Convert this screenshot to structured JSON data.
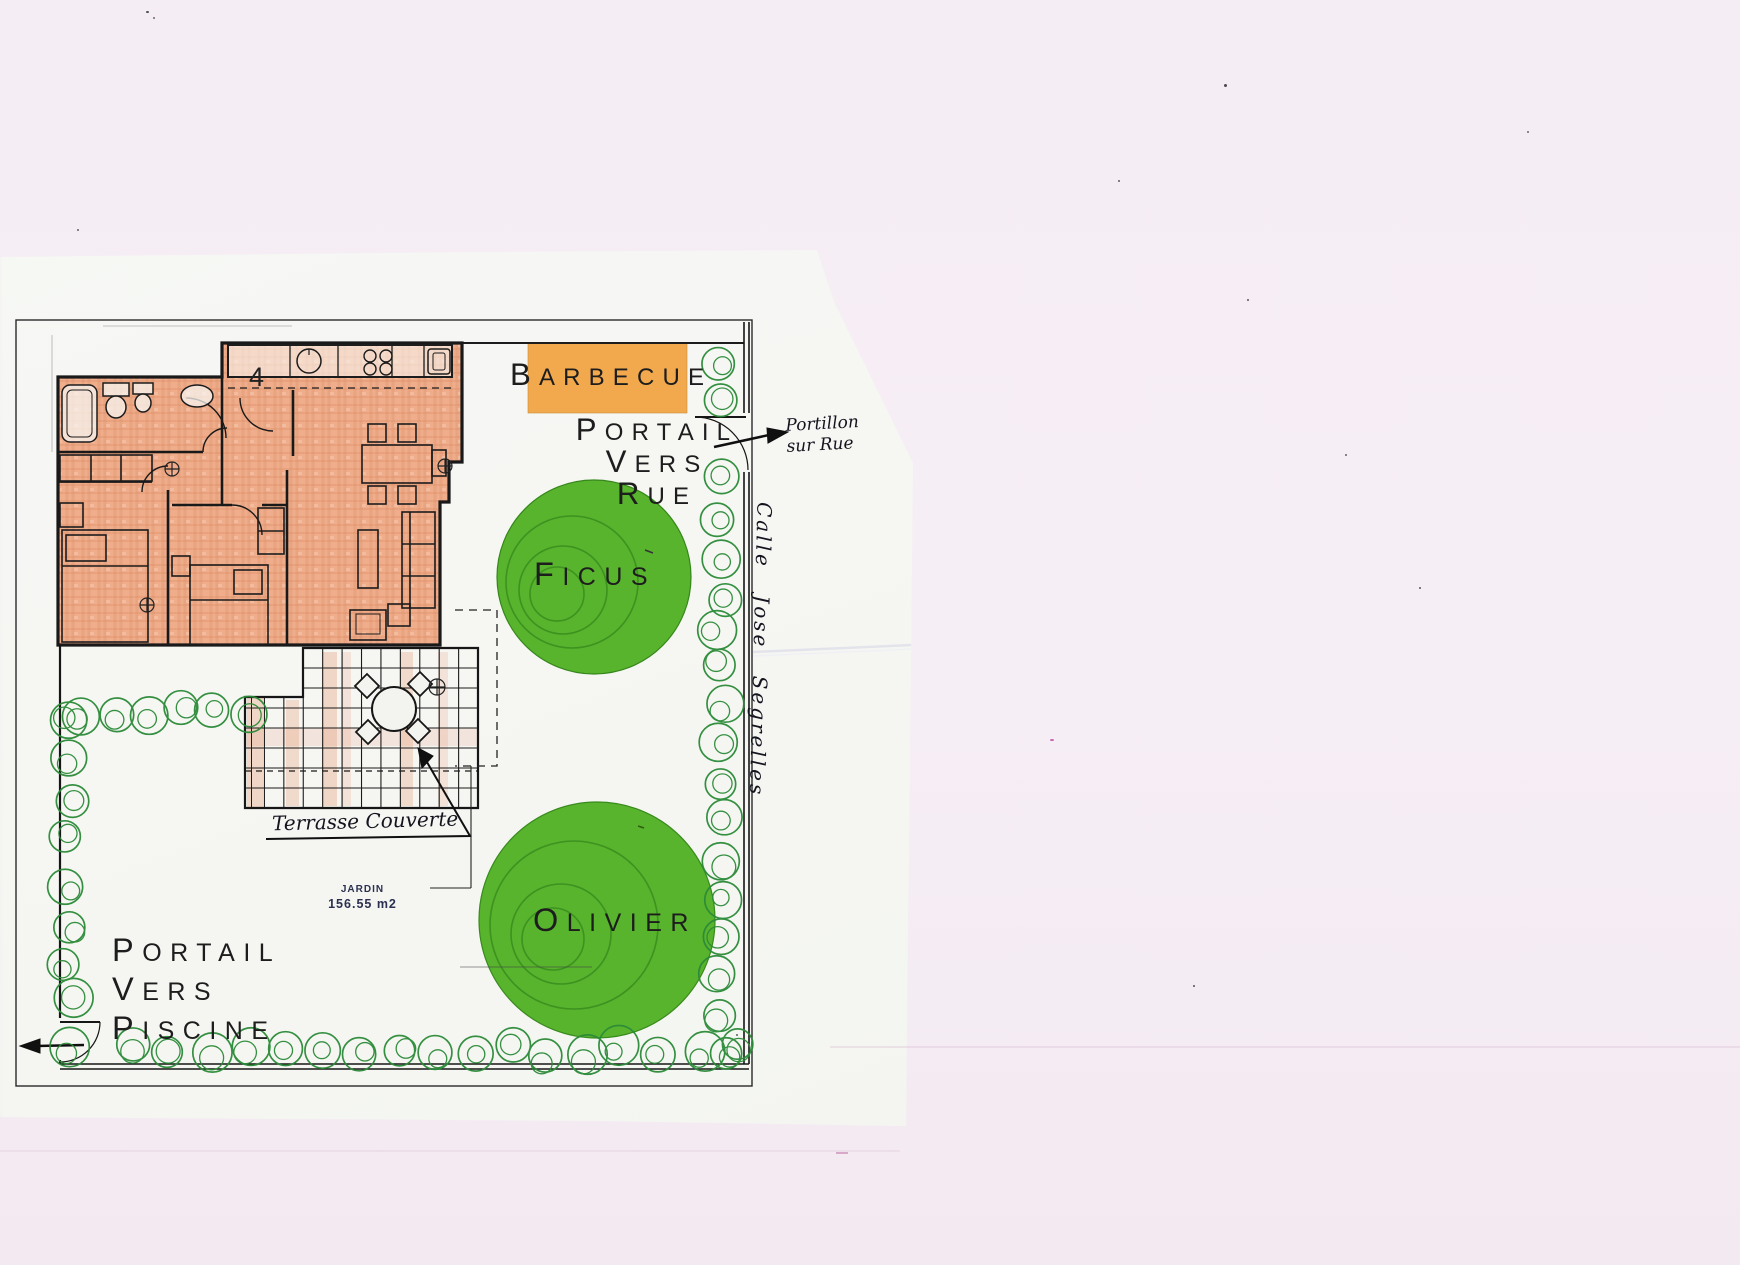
{
  "page": {
    "plan_labels": {
      "barbecue": "BARBECUE",
      "portail_rue": [
        "PORTAIL",
        "VERS",
        "RUE"
      ],
      "portail_piscine": [
        "PORTAIL",
        "VERS",
        "PISCINE"
      ],
      "ficus": "FICUS",
      "olivier": "OLIVIER",
      "jardin_name": "JARDIN",
      "jardin_area": "156.55 m2",
      "unit_number": "4"
    },
    "handwritten": {
      "portillon_line1": "Portillon",
      "portillon_line2": "sur Rue",
      "street_name": "Calle Jose Segrelles",
      "terrace": "Terrasse Couverte"
    }
  },
  "colors": {
    "background": "#f5edf4",
    "paper": "#f5f6f2",
    "crayon_fill": "#f0ad8c",
    "barbecue_fill": "#f2a94e",
    "tree_green": "#58b32d",
    "hedge_green": "#2b8a38",
    "ink": "#1d1d1d",
    "plan_blue_text": "#2b3050"
  }
}
